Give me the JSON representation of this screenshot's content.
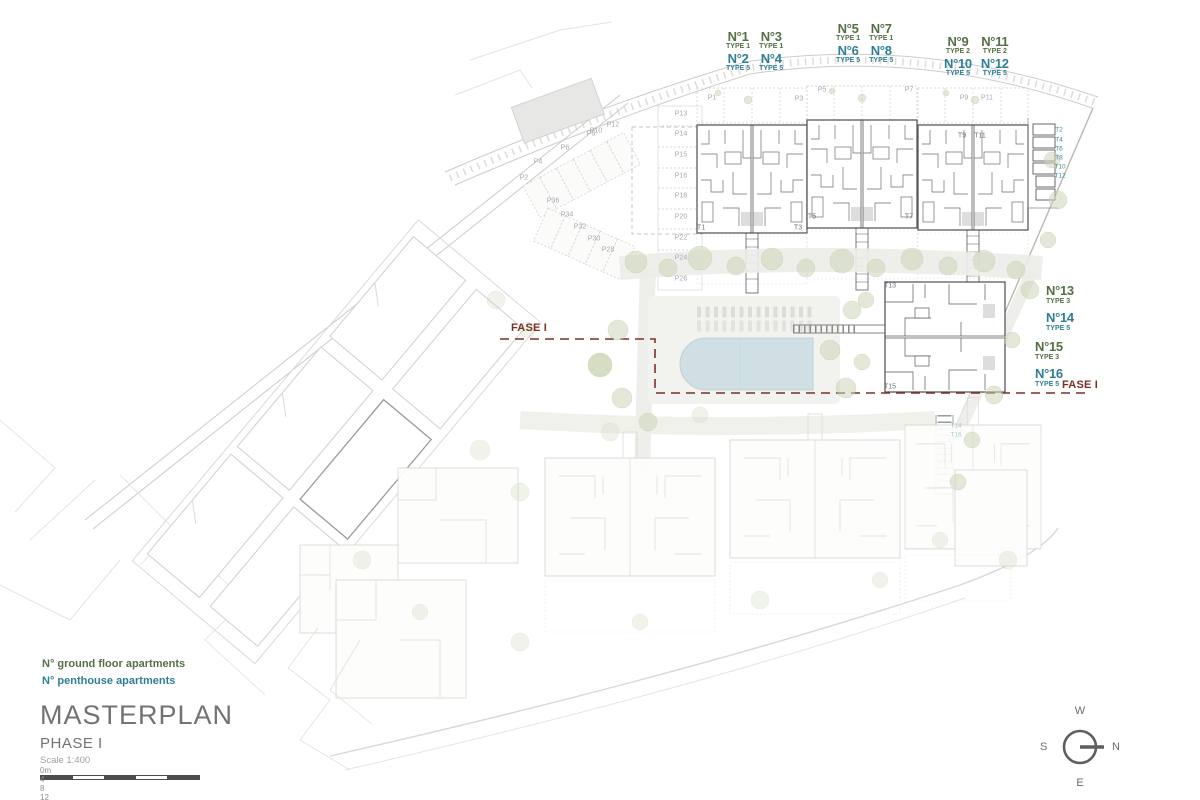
{
  "colors": {
    "ground_floor_green": "#557044",
    "penthouse_blue": "#2f7e95",
    "fase_red": "#7c2f26",
    "pool_blue": "#cfdfe4"
  },
  "unit_groups": [
    {
      "x": 726,
      "y": 30,
      "rows": [
        {
          "color": "green",
          "units": [
            {
              "no": "N°1",
              "type": "TYPE 1"
            },
            {
              "no": "N°3",
              "type": "TYPE 1"
            }
          ]
        },
        {
          "color": "blue",
          "units": [
            {
              "no": "N°2",
              "type": "TYPE 5"
            },
            {
              "no": "N°4",
              "type": "TYPE 5"
            }
          ]
        }
      ]
    },
    {
      "x": 836,
      "y": 22,
      "rows": [
        {
          "color": "green",
          "units": [
            {
              "no": "N°5",
              "type": "TYPE 1"
            },
            {
              "no": "N°7",
              "type": "TYPE 1"
            }
          ]
        },
        {
          "color": "blue",
          "units": [
            {
              "no": "N°6",
              "type": "TYPE 5"
            },
            {
              "no": "N°8",
              "type": "TYPE 5"
            }
          ]
        }
      ]
    },
    {
      "x": 944,
      "y": 35,
      "rows": [
        {
          "color": "green",
          "units": [
            {
              "no": "N°9",
              "type": "TYPE 2"
            },
            {
              "no": "N°11",
              "type": "TYPE 2"
            }
          ]
        },
        {
          "color": "blue",
          "units": [
            {
              "no": "N°10",
              "type": "TYPE 5"
            },
            {
              "no": "N°12",
              "type": "TYPE 5"
            }
          ]
        }
      ]
    }
  ],
  "side_units": [
    {
      "no": "N°13",
      "type": "TYPE 3",
      "color": "green",
      "x": 1046,
      "y": 284
    },
    {
      "no": "N°14",
      "type": "TYPE 5",
      "color": "blue",
      "x": 1046,
      "y": 311
    },
    {
      "no": "N°15",
      "type": "TYPE 3",
      "color": "green",
      "x": 1035,
      "y": 340
    },
    {
      "no": "N°16",
      "type": "TYPE 5",
      "color": "blue",
      "x": 1035,
      "y": 367
    }
  ],
  "fase_labels": [
    {
      "text": "FASE I",
      "x": 511,
      "y": 322
    },
    {
      "text": "FASE I",
      "x": 1062,
      "y": 379
    }
  ],
  "plan_labels": [
    {
      "t": "P1",
      "x": 712,
      "y": 98,
      "c": "p"
    },
    {
      "t": "P3",
      "x": 799,
      "y": 99,
      "c": "p"
    },
    {
      "t": "P5",
      "x": 822,
      "y": 90,
      "c": "p"
    },
    {
      "t": "P7",
      "x": 909,
      "y": 90,
      "c": "p"
    },
    {
      "t": "P9",
      "x": 964,
      "y": 98,
      "c": "p"
    },
    {
      "t": "P11",
      "x": 987,
      "y": 98,
      "c": "p"
    },
    {
      "t": "P13",
      "x": 681,
      "y": 114,
      "c": "p"
    },
    {
      "t": "P14",
      "x": 681,
      "y": 134,
      "c": "p"
    },
    {
      "t": "P15",
      "x": 681,
      "y": 155,
      "c": "p"
    },
    {
      "t": "P16",
      "x": 681,
      "y": 176,
      "c": "p"
    },
    {
      "t": "P18",
      "x": 681,
      "y": 196,
      "c": "p"
    },
    {
      "t": "P20",
      "x": 681,
      "y": 217,
      "c": "p"
    },
    {
      "t": "P22",
      "x": 681,
      "y": 238,
      "c": "p"
    },
    {
      "t": "P24",
      "x": 681,
      "y": 258,
      "c": "p"
    },
    {
      "t": "P26",
      "x": 681,
      "y": 279,
      "c": "p"
    },
    {
      "t": "P2",
      "x": 524,
      "y": 178,
      "c": "p"
    },
    {
      "t": "P4",
      "x": 538,
      "y": 162,
      "c": "p"
    },
    {
      "t": "P6",
      "x": 565,
      "y": 148,
      "c": "p"
    },
    {
      "t": "P8",
      "x": 591,
      "y": 134,
      "c": "p"
    },
    {
      "t": "P10",
      "x": 596,
      "y": 131,
      "c": "p"
    },
    {
      "t": "P12",
      "x": 613,
      "y": 125,
      "c": "p"
    },
    {
      "t": "P36",
      "x": 553,
      "y": 201,
      "c": "p"
    },
    {
      "t": "P34",
      "x": 567,
      "y": 215,
      "c": "p"
    },
    {
      "t": "P32",
      "x": 580,
      "y": 227,
      "c": "p"
    },
    {
      "t": "P30",
      "x": 594,
      "y": 239,
      "c": "p"
    },
    {
      "t": "P28",
      "x": 608,
      "y": 250,
      "c": "p"
    },
    {
      "t": "T1",
      "x": 701,
      "y": 228,
      "c": "t"
    },
    {
      "t": "T3",
      "x": 798,
      "y": 228,
      "c": "t"
    },
    {
      "t": "T5",
      "x": 812,
      "y": 217,
      "c": "t"
    },
    {
      "t": "T7",
      "x": 909,
      "y": 217,
      "c": "t"
    },
    {
      "t": "T9",
      "x": 962,
      "y": 136,
      "c": "t"
    },
    {
      "t": "T11",
      "x": 980,
      "y": 136,
      "c": "t"
    },
    {
      "t": "T13",
      "x": 890,
      "y": 286,
      "c": "t"
    },
    {
      "t": "T15",
      "x": 890,
      "y": 387,
      "c": "t"
    },
    {
      "t": "T2",
      "x": 1059,
      "y": 130,
      "c": "tt"
    },
    {
      "t": "T4",
      "x": 1059,
      "y": 140,
      "c": "tt"
    },
    {
      "t": "T6",
      "x": 1059,
      "y": 149,
      "c": "tt"
    },
    {
      "t": "T8",
      "x": 1059,
      "y": 158,
      "c": "tt"
    },
    {
      "t": "T10",
      "x": 1060,
      "y": 167,
      "c": "tt"
    },
    {
      "t": "T12",
      "x": 1060,
      "y": 176,
      "c": "tt"
    },
    {
      "t": "T14",
      "x": 956,
      "y": 426,
      "c": "tf"
    },
    {
      "t": "T16",
      "x": 956,
      "y": 435,
      "c": "tf"
    }
  ],
  "legend": {
    "ground": "N° ground floor apartments",
    "penthouse": "N° penthouse apartments"
  },
  "titleblock": {
    "title": "MASTERPLAN",
    "phase": "PHASE I",
    "scale_note": "Scale 1:400",
    "scalebar": [
      "0m",
      "4",
      "8",
      "12",
      "16",
      "20"
    ]
  },
  "compass": {
    "top": "W",
    "left": "S",
    "right": "N",
    "bottom": "E"
  }
}
